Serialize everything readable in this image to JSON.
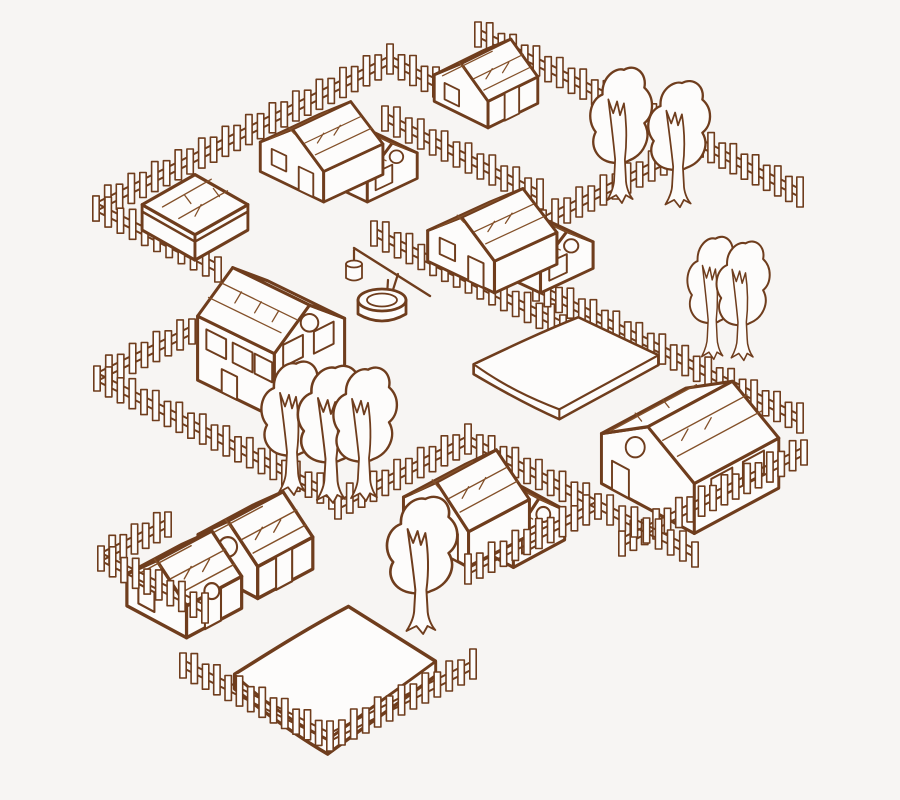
{
  "illustration": {
    "title": "isometric-village-line-art",
    "colors": {
      "line": "#6f3d1d",
      "line_light": "#835029",
      "fill": "#fdfcfb",
      "background": "#f7f5f3"
    },
    "canvas": {
      "width": 900,
      "height": 800
    },
    "fence_style": {
      "picket_width": 6.4,
      "picket_heights": [
        25,
        30
      ],
      "spacing": 13,
      "rail_offsets": [
        7,
        15
      ]
    },
    "fences_back": [
      {
        "name": "fence-topleft-north",
        "points": [
          [
            96,
            218
          ],
          [
            390,
            71
          ],
          [
            436,
            94
          ]
        ]
      },
      {
        "name": "fence-topright-north",
        "points": [
          [
            478,
            44
          ],
          [
            700,
            154
          ],
          [
            543,
            232
          ]
        ]
      },
      {
        "name": "fence-topright-east",
        "points": [
          [
            700,
            154
          ],
          [
            800,
            204
          ]
        ]
      },
      {
        "name": "fence-mid-northwest",
        "points": [
          [
            385,
            128
          ],
          [
            540,
            206
          ]
        ]
      },
      {
        "name": "fence-topleft-southwest",
        "points": [
          [
            96,
            218
          ],
          [
            218,
            279
          ]
        ]
      },
      {
        "name": "fence-left-middle",
        "points": [
          [
            192,
            341
          ],
          [
            97,
            388
          ],
          [
            332,
            506
          ]
        ]
      },
      {
        "name": "fence-well-yard",
        "points": [
          [
            374,
            243
          ],
          [
            563,
            337
          ]
        ]
      },
      {
        "name": "fence-field-northeast",
        "points": [
          [
            536,
            298
          ],
          [
            800,
            430
          ]
        ]
      },
      {
        "name": "fence-bottomcenter-north",
        "points": [
          [
            338,
            516
          ],
          [
            468,
            451
          ],
          [
            598,
            516
          ]
        ]
      }
    ],
    "fences_front": [
      {
        "name": "fence-right-southeast",
        "points": [
          [
            804,
            462
          ],
          [
            622,
            553
          ]
        ]
      },
      {
        "name": "fence-bottomcenter-southeast",
        "points": [
          [
            695,
            564
          ],
          [
            598,
            516
          ],
          [
            468,
            581
          ]
        ]
      },
      {
        "name": "fence-bottomleft-west",
        "points": [
          [
            168,
            534
          ],
          [
            101,
            568
          ],
          [
            205,
            620
          ]
        ]
      },
      {
        "name": "fence-bottomfield-south",
        "points": [
          [
            183,
            675
          ],
          [
            330,
            748
          ],
          [
            473,
            676
          ]
        ]
      }
    ],
    "objects": [
      {
        "name": "tree-1",
        "symbol": "tree",
        "x": 585,
        "y": 58,
        "w": 72,
        "h": 148
      },
      {
        "name": "tree-2",
        "symbol": "tree",
        "x": 643,
        "y": 72,
        "w": 72,
        "h": 138
      },
      {
        "name": "house-north",
        "symbol": "gable-house",
        "x": 428,
        "y": 36,
        "w": 116,
        "h": 100
      },
      {
        "name": "house-northwest",
        "symbol": "l-house",
        "x": 253,
        "y": 76,
        "w": 185,
        "h": 130
      },
      {
        "name": "shed-west",
        "symbol": "shed",
        "x": 136,
        "y": 170,
        "w": 118,
        "h": 97
      },
      {
        "name": "house-central",
        "symbol": "l-house",
        "x": 420,
        "y": 162,
        "w": 195,
        "h": 135
      },
      {
        "name": "tree-3",
        "symbol": "tree",
        "x": 683,
        "y": 228,
        "w": 60,
        "h": 134
      },
      {
        "name": "tree-4",
        "symbol": "tree",
        "x": 712,
        "y": 233,
        "w": 62,
        "h": 130
      },
      {
        "name": "well",
        "symbol": "well",
        "x": 336,
        "y": 238,
        "w": 100,
        "h": 92
      },
      {
        "name": "house-west-tall",
        "symbol": "tall-house",
        "x": 191,
        "y": 250,
        "w": 158,
        "h": 172
      },
      {
        "name": "field-bed-east",
        "symbol": "slab",
        "x": 466,
        "y": 310,
        "w": 200,
        "h": 112
      },
      {
        "name": "tree-5",
        "symbol": "tree",
        "x": 256,
        "y": 352,
        "w": 74,
        "h": 146
      },
      {
        "name": "tree-6",
        "symbol": "tree",
        "x": 292,
        "y": 356,
        "w": 80,
        "h": 150
      },
      {
        "name": "tree-7",
        "symbol": "tree",
        "x": 328,
        "y": 358,
        "w": 74,
        "h": 146
      },
      {
        "name": "house-east",
        "symbol": "long-house",
        "x": 593,
        "y": 370,
        "w": 190,
        "h": 168
      },
      {
        "name": "house-bottomcenter",
        "symbol": "l-house",
        "x": 396,
        "y": 420,
        "w": 190,
        "h": 152
      },
      {
        "name": "tree-9",
        "symbol": "tree",
        "x": 381,
        "y": 487,
        "w": 82,
        "h": 150
      },
      {
        "name": "house-southwest",
        "symbol": "duplex",
        "x": 120,
        "y": 488,
        "w": 202,
        "h": 162
      },
      {
        "name": "field-bed-south",
        "symbol": "slab",
        "x": 226,
        "y": 596,
        "w": 218,
        "h": 162
      }
    ]
  }
}
